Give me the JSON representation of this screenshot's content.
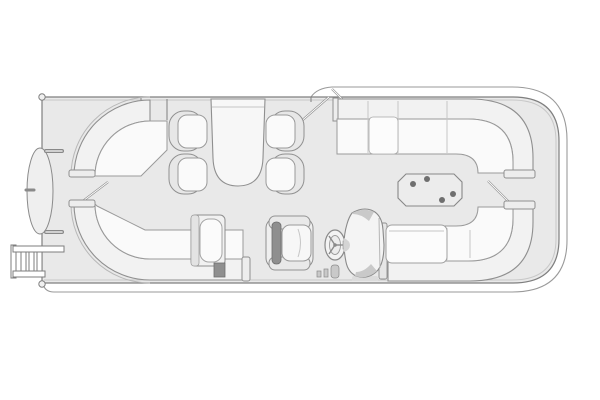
{
  "diagram": {
    "type": "pontoon-boat-floor-plan",
    "title": "Pontoon boat deck floor plan, top view",
    "view": "overhead line drawing, hull oriented horizontally, rounded cap on right end, nose cone and boarding ladder on left end",
    "colors": {
      "background": "#ffffff",
      "deck": "#e9e9e9",
      "hull_outline": "#7f7f7f",
      "outer_hull_line": "#9a9a9a",
      "furniture_band": "#f2f2f2",
      "cushion": "#fafafa",
      "seam": "#c6c6c6",
      "dark_accent": "#8f8f8f",
      "cup_holder": "#6f6f6f"
    },
    "counts": {
      "dinette_seats": 4,
      "wraparound_lounges": 4,
      "tables": 2,
      "gate_doors_open": 4,
      "cup_holders": 4,
      "ladder_rungs": 3
    },
    "components": [
      {
        "id": "hull-outline",
        "label": "Outer pontoon hull / rub rail line"
      },
      {
        "id": "deck",
        "label": "Main deck platform"
      },
      {
        "id": "nose-cone",
        "label": "Left-end nose cone (elliptical)"
      },
      {
        "id": "grab-handle-top",
        "label": "Upper grab handle at nose"
      },
      {
        "id": "grab-handle-bottom",
        "label": "Lower grab handle at nose"
      },
      {
        "id": "boarding-ladder",
        "label": "Boarding ladder, lower-left"
      },
      {
        "id": "left-gate-door",
        "label": "Open gate door, left side"
      },
      {
        "id": "top-gate-doors",
        "label": "Open double gate doors, top center"
      },
      {
        "id": "right-gate-door",
        "label": "Open gate door, right side"
      },
      {
        "id": "upper-left-lounge",
        "label": "Curved wrap-around lounge, upper-left corner"
      },
      {
        "id": "lower-left-lounge",
        "label": "Curved wrap-around lounge with chaise, lower-left corner"
      },
      {
        "id": "dinette-table",
        "label": "Pedestal dinette table, top center"
      },
      {
        "id": "dinette-seat",
        "label": "Bucket dinette seat (x4)"
      },
      {
        "id": "upper-right-lounge",
        "label": "Curved wrap-around lounge, upper-right corner"
      },
      {
        "id": "lower-right-lounge",
        "label": "Curved wrap-around lounge with sun pad, lower-right corner"
      },
      {
        "id": "cocktail-table",
        "label": "Octagonal cocktail table with four cup holders"
      },
      {
        "id": "captains-chair",
        "label": "Captain's chair with armrests"
      },
      {
        "id": "steering-wheel",
        "label": "Three-spoke steering wheel"
      },
      {
        "id": "helm-console",
        "label": "Helm console"
      },
      {
        "id": "helm-controls",
        "label": "Small helm-side controls"
      }
    ]
  }
}
